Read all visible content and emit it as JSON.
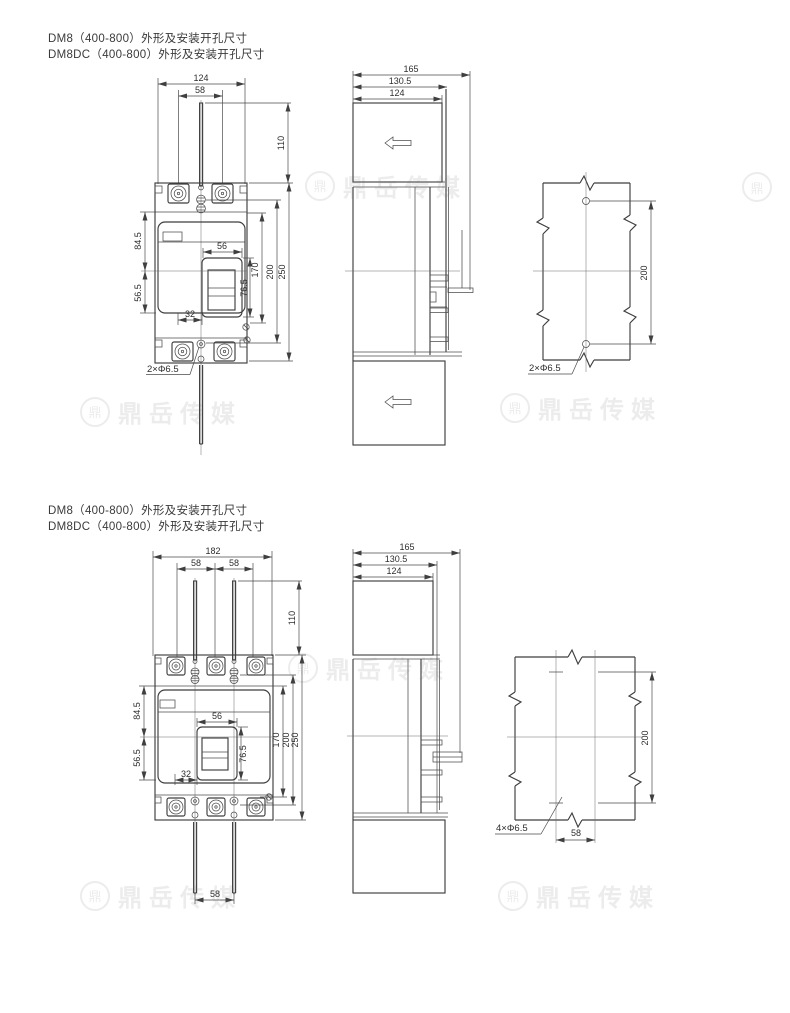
{
  "page": {
    "background": "#ffffff",
    "line_color": "#3f3f3f",
    "watermark": {
      "logo_char": "鼎",
      "text": "鼎岳传媒"
    }
  },
  "section1": {
    "title_line1": "DM8（400-800）外形及安装开孔尺寸",
    "title_line2": "DM8DC（400-800）外形及安装开孔尺寸",
    "front": {
      "width_overall": "124",
      "pole_pitch": "58",
      "rod_height": "110",
      "upper_height": "84.5",
      "handle_width": "56",
      "lower_height": "56.5",
      "offset": "32",
      "handle_height": "76.5",
      "height_170": "170",
      "height_200": "200",
      "height_250": "250",
      "hole_callout": "2×Φ6.5"
    },
    "side": {
      "depth_165": "165",
      "depth_130_5": "130.5",
      "depth_124": "124"
    },
    "mount": {
      "hole_pitch_200": "200",
      "hole_callout": "2×Φ6.5"
    }
  },
  "section2": {
    "title_line1": "DM8（400-800）外形及安装开孔尺寸",
    "title_line2": "DM8DC（400-800）外形及安装开孔尺寸",
    "front": {
      "width_overall": "182",
      "pole_pitch_left": "58",
      "pole_pitch_right": "58",
      "rod_height": "110",
      "upper_height": "84.5",
      "handle_width": "56",
      "lower_height": "56.5",
      "offset": "32",
      "handle_height": "76.5",
      "height_170": "170",
      "height_200": "200",
      "height_250": "250",
      "rod_pitch_bottom": "58"
    },
    "side": {
      "depth_165": "165",
      "depth_130_5": "130.5",
      "depth_124": "124"
    },
    "mount": {
      "hole_pitch_200": "200",
      "hole_pitch_58": "58",
      "hole_callout": "4×Φ6.5"
    }
  }
}
